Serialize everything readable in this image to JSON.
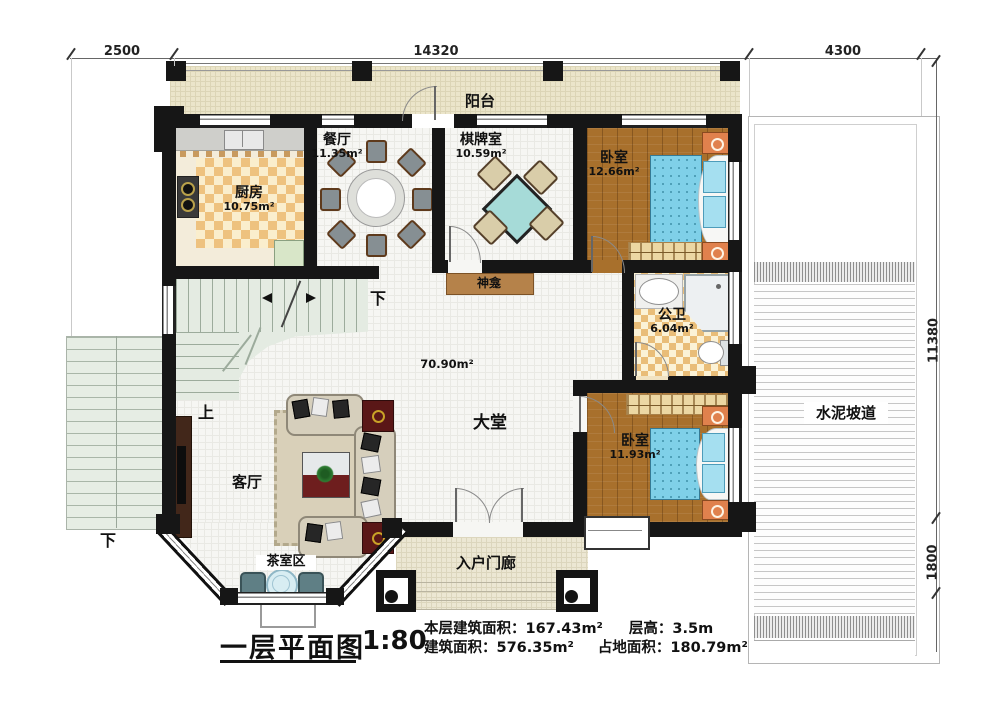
{
  "plan": {
    "title": "一层平面图",
    "scale": "1:80",
    "stats": {
      "floor_area": "本层建筑面积：167.43m²",
      "storey_height": "层高：3.5m",
      "build_area": "建筑面积：576.35m²",
      "land_area": "占地面积：180.79m²"
    }
  },
  "dimensions": {
    "top_left": "2500",
    "top_middle": "14320",
    "top_right": "4300",
    "right_upper": "11380",
    "right_lower": "1800"
  },
  "rooms": {
    "balcony": {
      "label": "阳台"
    },
    "kitchen": {
      "label": "厨房",
      "area": "10.75m²"
    },
    "dining": {
      "label": "餐厅",
      "area": "11.35m²"
    },
    "chess": {
      "label": "棋牌室",
      "area": "10.59m²"
    },
    "bedroom1": {
      "label": "卧室",
      "area": "12.66m²"
    },
    "bathroom": {
      "label": "公卫",
      "area": "6.04m²"
    },
    "hall": {
      "label": "大堂",
      "area": "70.90m²"
    },
    "living": {
      "label": "客厅"
    },
    "bedroom2": {
      "label": "卧室",
      "area": "11.93m²"
    },
    "tea_area": {
      "label": "茶室区"
    },
    "porch": {
      "label": "入户门廊"
    },
    "ramp": {
      "label": "水泥坡道"
    },
    "shrine": {
      "label": "神龛"
    }
  },
  "directions": {
    "stairs_down": "下",
    "stairs_up": "上",
    "exterior_down": "下"
  },
  "colors": {
    "wall": "#161616",
    "wood_floor": "#a8702c",
    "bed": "#7fd0e8",
    "kitchen_checker": "#eec27f",
    "balcony_floor": "#ebe5ca",
    "stair": "#e4ebe2",
    "nightstand": "#e0814d"
  }
}
